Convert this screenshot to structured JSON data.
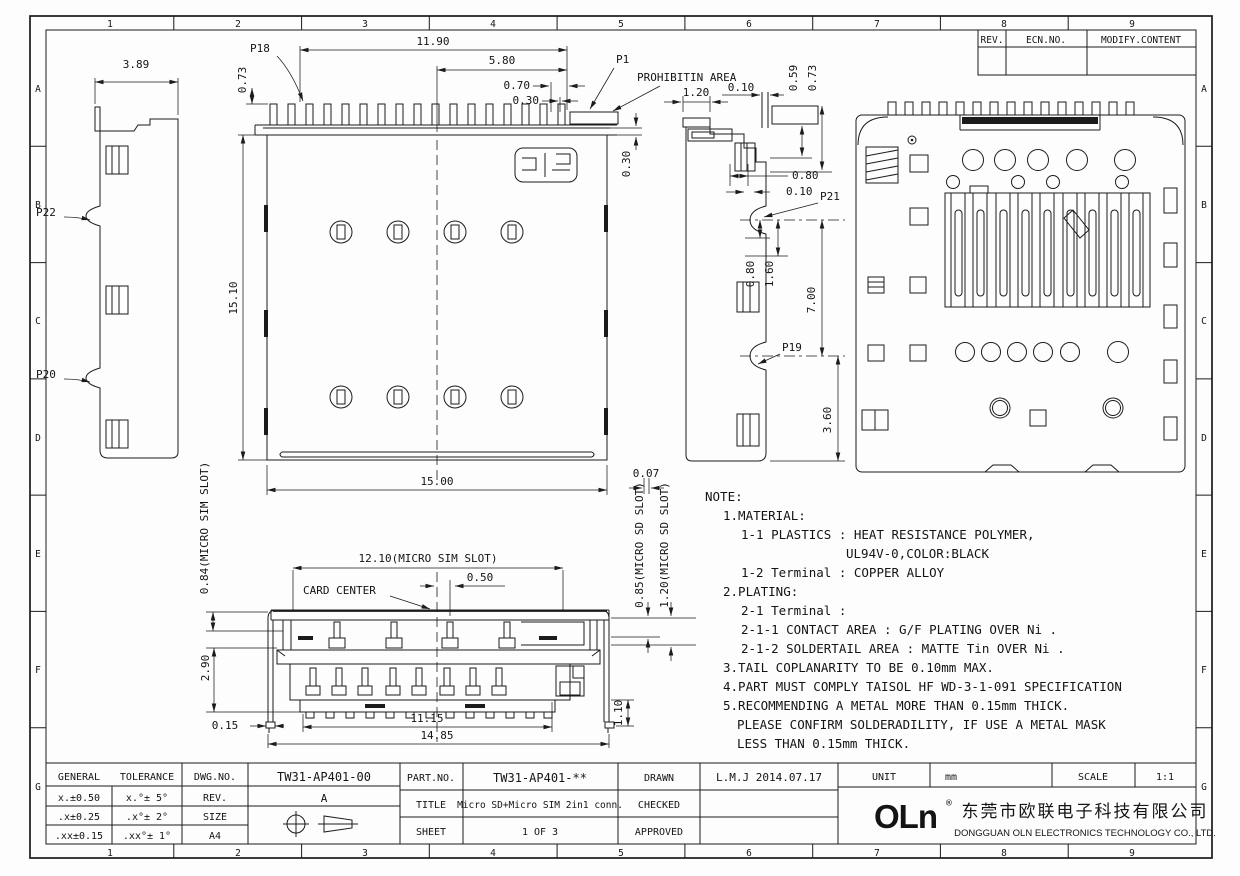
{
  "border": {
    "cols": [
      "1",
      "2",
      "3",
      "4",
      "5",
      "6",
      "7",
      "8",
      "9"
    ],
    "rows": [
      "A",
      "B",
      "C",
      "D",
      "E",
      "F",
      "G"
    ]
  },
  "rev_table": {
    "rev": "REV.",
    "ecn": "ECN.NO.",
    "modify": "MODIFY.CONTENT"
  },
  "labels": {
    "p1": "P1",
    "p18": "P18",
    "p19": "P19",
    "p20": "P20",
    "p21": "P21",
    "p22": "P22",
    "prohibit": "PROHIBITIN AREA",
    "card_center": "CARD CENTER"
  },
  "dims": {
    "left_w": "3.89",
    "pin_span": "11.90",
    "pin_half": "5.80",
    "pin_a": "0.70",
    "pin_b": "0.30",
    "pin_h": "0.73",
    "hatch_w": "1.20",
    "hatch_gap": "0.10",
    "h_059": "0.59",
    "h_073": "0.73",
    "body_h": "15.10",
    "body_w": "15.00",
    "edge_030": "0.30",
    "r_080a": "0.80",
    "r_010": "0.10",
    "r_080b": "0.80",
    "r_160": "1.60",
    "r_700": "7.00",
    "r_360": "3.60",
    "sim_w": "12.10(MICRO SIM SLOT)",
    "off_050": "0.50",
    "sim_h": "0.84(MICRO SIM SLOT)",
    "f_290": "2.90",
    "f_015": "0.15",
    "f_1115": "11.15",
    "f_1485": "14.85",
    "f_110": "1.10",
    "f_007": "0.07",
    "sd_h1": "0.85(MICRO SD SLOT)",
    "sd_h2": "1.20(MICRO SD SLOT)"
  },
  "note": {
    "lines": [
      "NOTE:",
      "1.MATERIAL:",
      "1-1 PLASTICS : HEAT RESISTANCE POLYMER,",
      "UL94V-0,COLOR:BLACK",
      "1-2 Terminal : COPPER ALLOY",
      "2.PLATING:",
      "2-1 Terminal :",
      "2-1-1 CONTACT AREA : G/F PLATING OVER Ni .",
      "2-1-2 SOLDERTAIL AREA : MATTE Tin  OVER Ni .",
      "3.TAIL COPLANARITY TO BE 0.10mm MAX.",
      "4.PART MUST COMPLY TAISOL HF WD-3-1-091 SPECIFICATION",
      "5.RECOMMENDING A METAL MORE THAN  0.15mm THICK.",
      "PLEASE CONFIRM SOLDERADILITY, IF USE A METAL MASK",
      "LESS THAN 0.15mm THICK."
    ]
  },
  "title_block": {
    "general": "GENERAL",
    "tolerance": "TOLERANCE",
    "tol_rows": [
      [
        "x.±0.50",
        "x.°± 5°"
      ],
      [
        ".x±0.25",
        ".x°± 2°"
      ],
      [
        ".xx±0.15",
        ".xx°± 1°"
      ]
    ],
    "dwg_label": "DWG.NO.",
    "dwg_no": "TW31-AP401-00",
    "rev_label": "REV.",
    "rev": "A",
    "size_label": "SIZE",
    "size": "A4",
    "part_label": "PART.NO.",
    "part_no": "TW31-AP401-**",
    "title_label": "TITLE",
    "title": "Micro SD+Micro SIM 2in1 conn.",
    "sheet_label": "SHEET",
    "sheet": "1 OF 3",
    "drawn_label": "DRAWN",
    "drawn": "L.M.J 2014.07.17",
    "checked_label": "CHECKED",
    "approved_label": "APPROVED",
    "unit_label": "UNIT",
    "unit": "mm",
    "scale_label": "SCALE",
    "scale": "1:1",
    "logo": "OLn",
    "logo_reg": "®",
    "company_cn": "东莞市欧联电子科技有限公司",
    "company_en": "DONGGUAN OLN ELECTRONICS TECHNOLOGY CO., LTD."
  }
}
